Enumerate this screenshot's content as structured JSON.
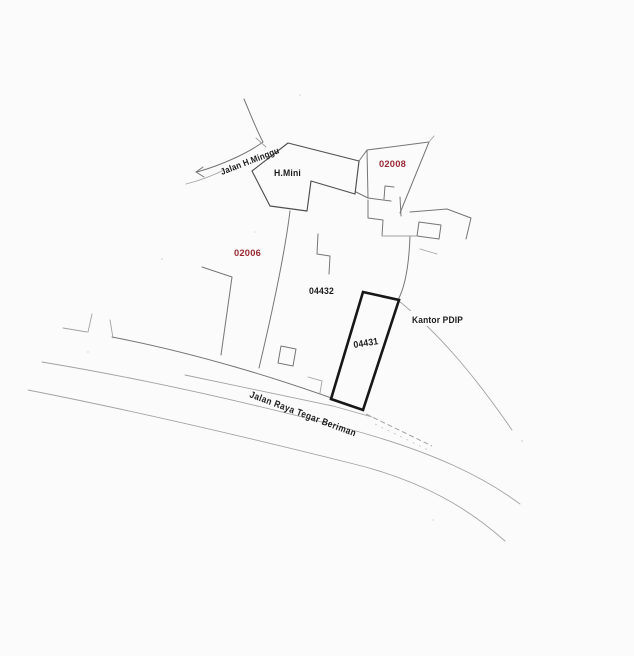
{
  "roads": [
    {
      "label": "Jalan H.Minggu"
    },
    {
      "label": "Jalan Raya Tegar Beriman"
    }
  ],
  "buildings": [
    {
      "label": "H.Mini"
    }
  ],
  "parcels": [
    {
      "id": "02006",
      "label_color": "red"
    },
    {
      "id": "02008",
      "label_color": "red"
    },
    {
      "id": "04431",
      "label_color": "black",
      "highlighted": true
    },
    {
      "id": "04432",
      "label_color": "black"
    }
  ],
  "annotations": [
    {
      "label": "Kantor PDIP"
    }
  ],
  "colors": {
    "paper": "#fbfbfb",
    "ink": "#1c1c1c",
    "parcel_red": "#9a2b34",
    "line_light": "#a2a2a2",
    "line_medium": "#767676",
    "outline_dark": "#4f4f4f",
    "outline_bold": "#171717"
  }
}
